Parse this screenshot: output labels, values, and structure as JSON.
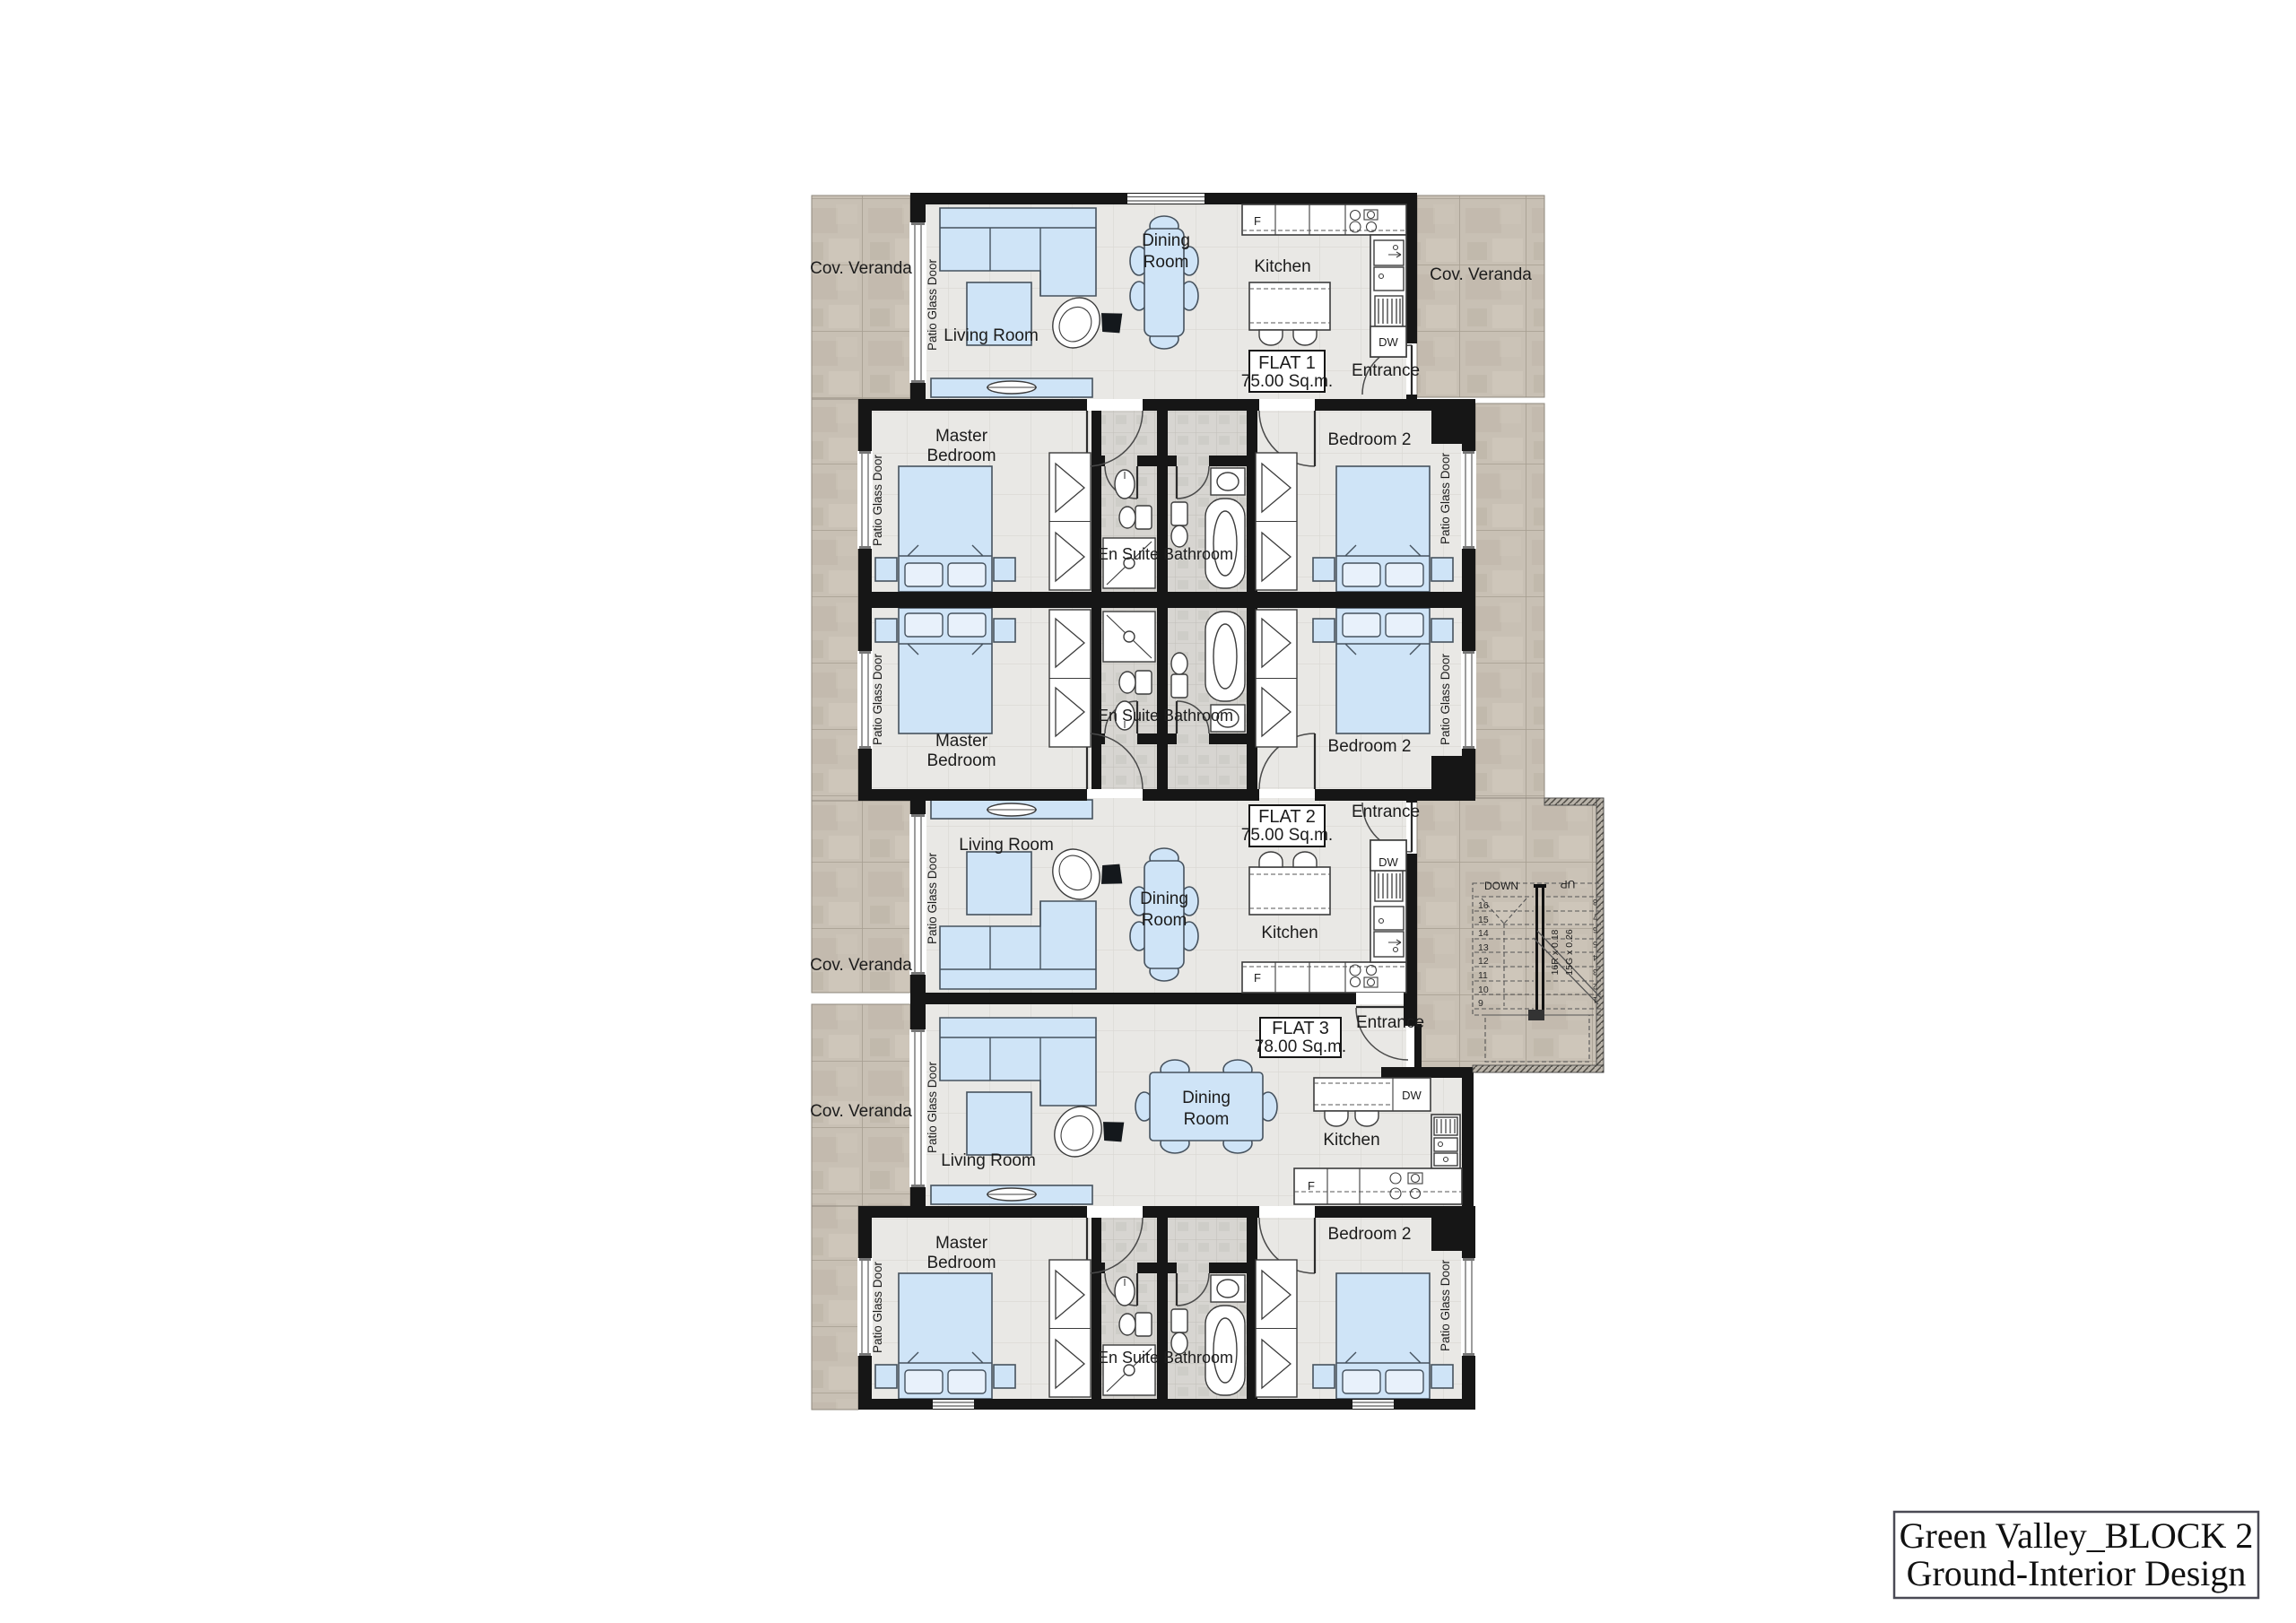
{
  "title_block": {
    "line1": "Green Valley_BLOCK 2",
    "line2": "Ground-Interior Design"
  },
  "flats": [
    {
      "name": "FLAT 1",
      "area": "75.00 Sq.m."
    },
    {
      "name": "FLAT 2",
      "area": "75.00 Sq.m."
    },
    {
      "name": "FLAT 3",
      "area": "78.00 Sq.m."
    }
  ],
  "labels": {
    "cov_veranda": "Cov. Veranda",
    "patio_glass_door": "Patio Glass Door",
    "living_room": "Living Room",
    "dining_line1": "Dining",
    "dining_line2": "Room",
    "kitchen": "Kitchen",
    "entrance": "Entrance",
    "master_line1": "Master",
    "master_line2": "Bedroom",
    "bedroom2": "Bedroom 2",
    "en_suite": "En Suite",
    "bathroom": "Bathroom",
    "fridge": "F",
    "dishwasher": "DW"
  },
  "stairs": {
    "down": "DOWN",
    "up": "UP",
    "riser_note": "16R x 0.18",
    "going_note": "15G x 0.26",
    "left_flight_numbers": [
      "16",
      "15",
      "14",
      "13",
      "12",
      "11",
      "10",
      "9"
    ],
    "right_flight_numbers": [
      "8",
      "7",
      "6",
      "5",
      "4",
      "3",
      "2",
      "1"
    ]
  },
  "colors": {
    "wall": "#161616",
    "furniture_blue": "#cfe4f7",
    "veranda_base": "#c8c0b4",
    "floor_base": "#e9e8e5",
    "tile_base": "#d7d5d1"
  }
}
